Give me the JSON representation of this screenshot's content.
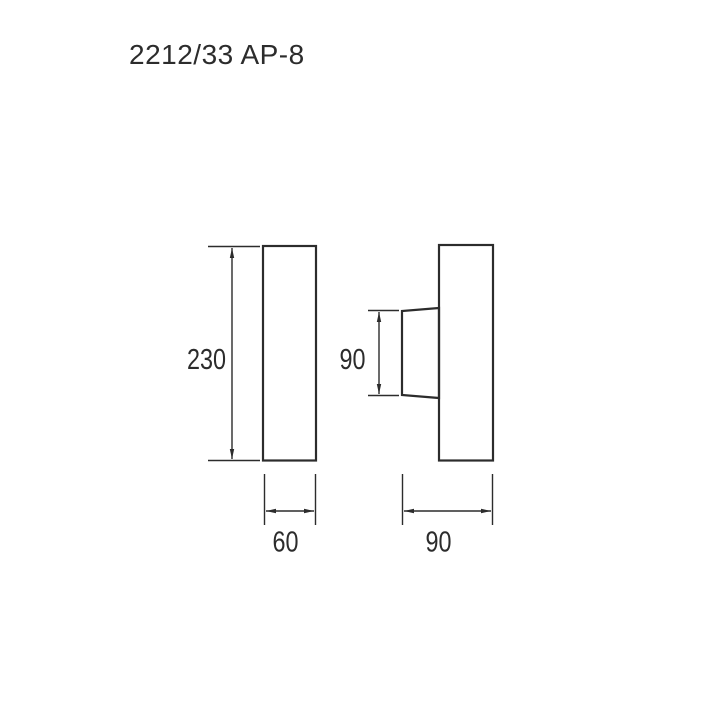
{
  "title": "2212/33 AP-8",
  "colors": {
    "background": "#ffffff",
    "line": "#2c2c2c",
    "text": "#2c2c2c"
  },
  "drawing": {
    "type": "technical-dimension-drawing",
    "views": {
      "front": {
        "height_label": "230",
        "width_label": "60"
      },
      "side": {
        "bracket_height_label": "90",
        "depth_label": "90"
      }
    }
  }
}
